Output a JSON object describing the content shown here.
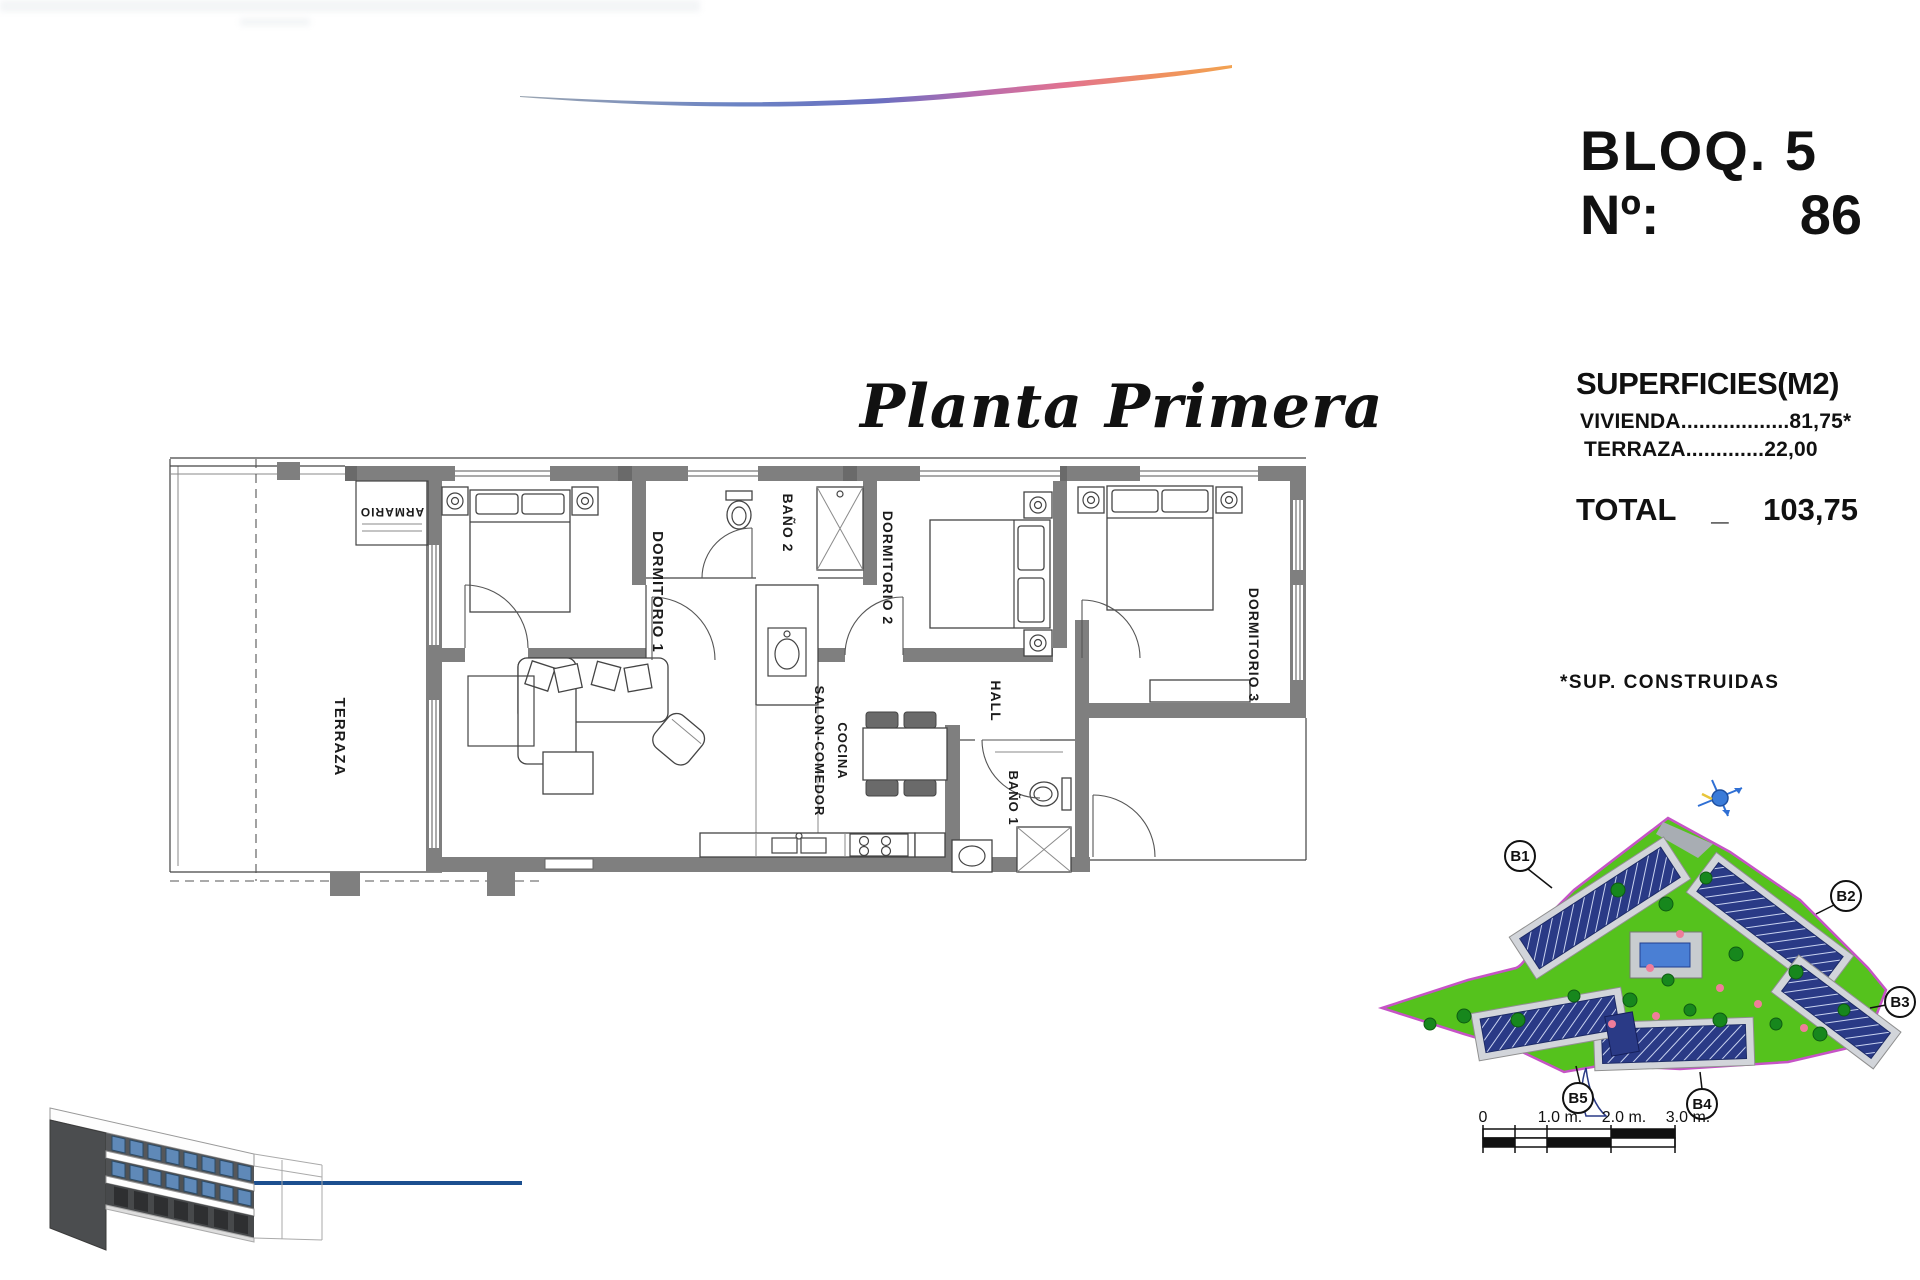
{
  "header": {
    "block": "BLOQ. 5",
    "number_label": "Nº:",
    "number_value": "86"
  },
  "plan_title": "Planta Primera",
  "surfaces": {
    "title": "SUPERFICIES(M2)",
    "vivienda_label": "VIVIENDA",
    "vivienda_dots": "..................",
    "vivienda_value": "81,75*",
    "terraza_label": "TERRAZA",
    "terraza_dots": ".............",
    "terraza_value": "22,00",
    "total_label": "TOTAL",
    "total_separator": "_",
    "total_value": "103,75",
    "footnote": "*SUP. CONSTRUIDAS"
  },
  "rooms": {
    "terraza": "TERRAZA",
    "armario": "ARMARIO",
    "dormitorio1": "DORMITORIO 1",
    "bano2": "BAÑO 2",
    "dormitorio2": "DORMITORIO 2",
    "dormitorio3": "DORMITORIO 3",
    "hall": "HALL",
    "salon_line1": "SALON-COMEDOR",
    "salon_line2": "COCINA",
    "bano1": "BAÑO 1"
  },
  "site_plan": {
    "b1": "B1",
    "b2": "B2",
    "b3": "B3",
    "b4": "B4",
    "b5": "B5"
  },
  "scale_bar": {
    "t0": "0",
    "t1": "1.0 m.",
    "t2": "2.0 m.",
    "t3": "3.0 m."
  },
  "colors": {
    "wall_gray": "#7f7f7f",
    "site_green": "#55c21d",
    "site_boundary": "#c653c6",
    "building_navy": "#2a3a86",
    "pool_blue": "#4a7fd4",
    "wave_blue": "#5b79c4",
    "wave_pink": "#e2738f",
    "wave_orange": "#f2a44f",
    "render_line": "#1c4f8f"
  }
}
